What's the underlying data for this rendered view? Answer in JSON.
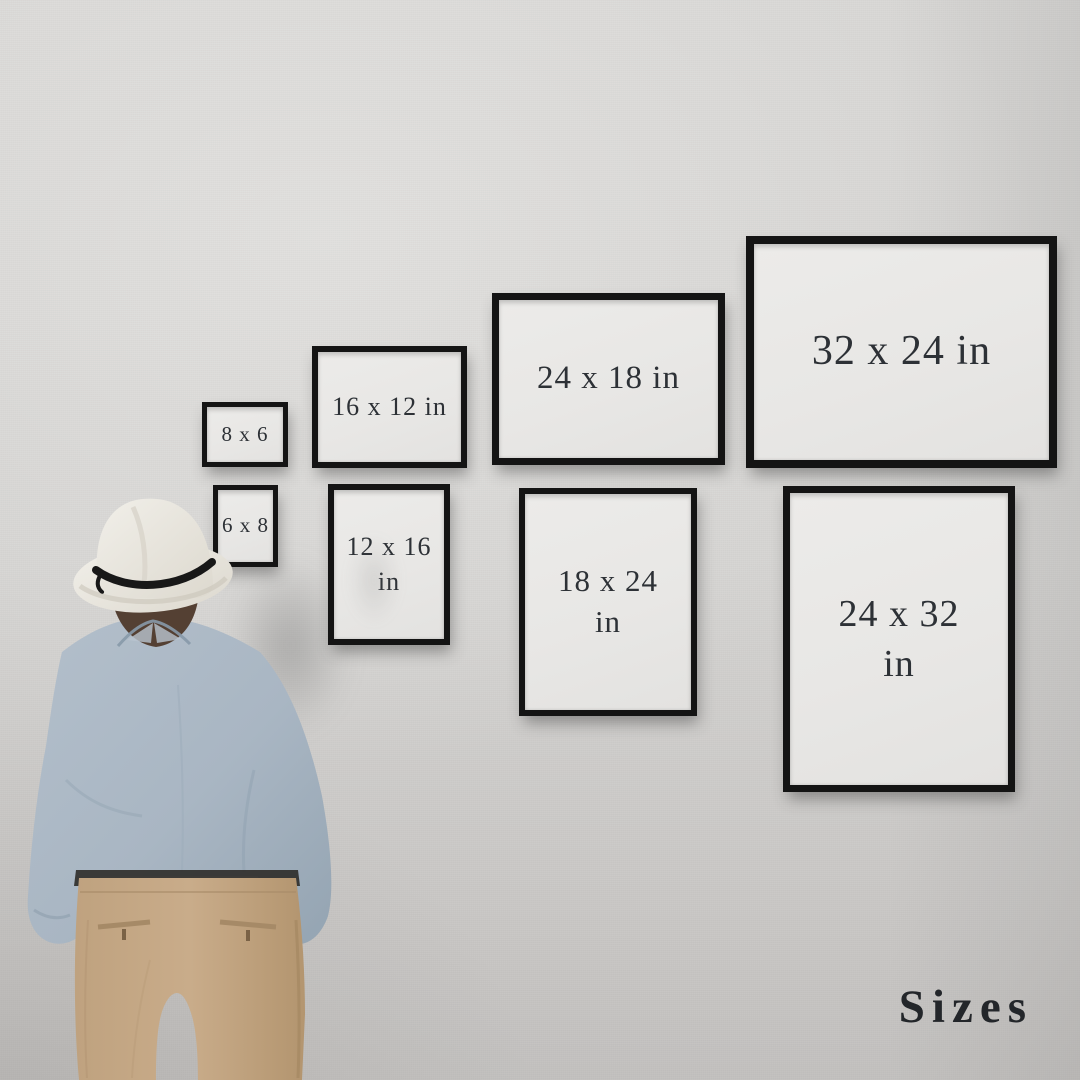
{
  "scene": {
    "title": "Sizes",
    "description": "man in fedora viewing wall of black frames showing print sizes"
  },
  "frames": [
    {
      "name": "frame-8x6",
      "label": "8 x 6",
      "orientation": "landscape"
    },
    {
      "name": "frame-16x12",
      "label": "16 x 12 in",
      "orientation": "landscape"
    },
    {
      "name": "frame-24x18",
      "label": "24 x 18 in",
      "orientation": "landscape"
    },
    {
      "name": "frame-32x24",
      "label": "32 x 24 in",
      "orientation": "landscape"
    },
    {
      "name": "frame-6x8",
      "label": "6 x 8",
      "orientation": "portrait"
    },
    {
      "name": "frame-12x16",
      "label": "12 x 16\nin",
      "orientation": "portrait"
    },
    {
      "name": "frame-18x24",
      "label": "18 x 24\nin",
      "orientation": "portrait"
    },
    {
      "name": "frame-24x32",
      "label": "24 x 32\nin",
      "orientation": "portrait"
    }
  ],
  "colors": {
    "wall": "#d4d3d1",
    "frame_border": "#141414",
    "frame_mat": "#e9e8e6",
    "label_text": "#2d3136",
    "title_text": "#23262a",
    "hat": "#ebe8e2",
    "hat_band": "#181818",
    "hair": "#544033",
    "shirt": "#a9b6c3",
    "pants": "#c5a886",
    "belt": "#2e2c29"
  }
}
